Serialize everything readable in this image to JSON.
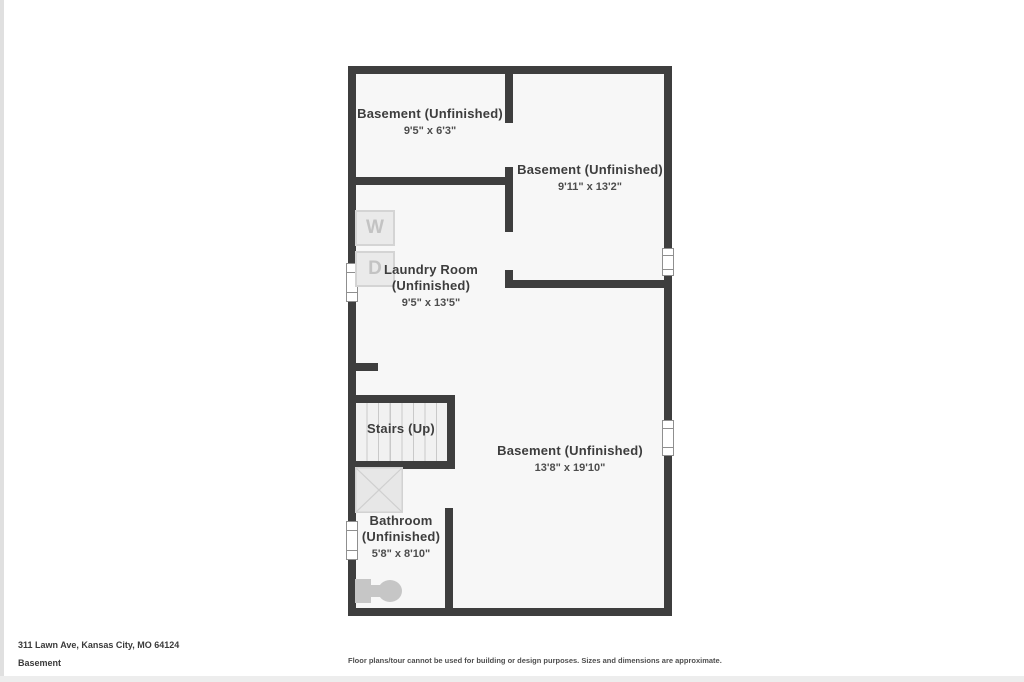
{
  "colors": {
    "wall": "#3e3e3e",
    "room_fill": "#f7f7f7",
    "label_text": "#3d3d3d",
    "appliance_fill": "#eaeaea",
    "appliance_border": "#d4d4d4",
    "appliance_letter": "#c3c3c3",
    "fixture_gray": "#c6c6c6"
  },
  "rooms": {
    "basement_top_left": {
      "line1": "Basement (Unfinished)",
      "dims": "9'5\" x 6'3\""
    },
    "basement_right": {
      "line1": "Basement (Unfinished)",
      "dims": "9'11\" x 13'2\""
    },
    "laundry": {
      "line1": "Laundry Room",
      "line2": "(Unfinished)",
      "dims": "9'5\" x 13'5\""
    },
    "stairs": {
      "line1": "Stairs (Up)"
    },
    "basement_main": {
      "line1": "Basement (Unfinished)",
      "dims": "13'8\" x 19'10\""
    },
    "bathroom": {
      "line1": "Bathroom",
      "line2": "(Unfinished)",
      "dims": "5'8\" x 8'10\""
    }
  },
  "appliances": {
    "washer": "W",
    "dryer": "D"
  },
  "footer": {
    "address": "311 Lawn Ave, Kansas City, MO 64124",
    "floor": "Basement",
    "disclaimer": "Floor plans/tour cannot be used for building or design purposes. Sizes and dimensions are approximate."
  }
}
